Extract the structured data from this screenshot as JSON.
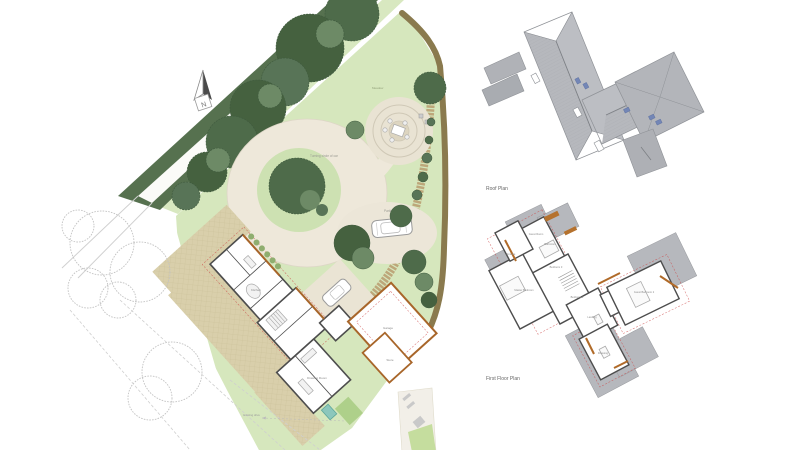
{
  "site_plan": {
    "north_label": "N",
    "road_label": "Bridleway Drive",
    "labels": {
      "turning_circle": "Turning circle of car",
      "parking": "Parking",
      "meadow": "Meadow",
      "garage": "Garage",
      "kitchen": "Kitchen",
      "drawing_room": "Drawing Room",
      "store": "Store",
      "existing_drive": "Existing drive"
    }
  },
  "roof_plan": {
    "caption": "Roof Plan"
  },
  "first_floor_plan": {
    "caption": "First Floor Plan",
    "rooms": [
      {
        "label": "Guest Room"
      },
      {
        "label": "Ensuite"
      },
      {
        "label": "Bathroom"
      },
      {
        "label": "Bedroom 3"
      },
      {
        "label": "Master Bedroom"
      },
      {
        "label": "Bedroom 2"
      },
      {
        "label": "Landing"
      },
      {
        "label": "Guest Bedroom 2"
      },
      {
        "label": "Dressing"
      }
    ]
  },
  "colors": {
    "tree_dark": "#4e6b4a",
    "tree_mid": "#6d8a66",
    "lawn": "#d6e7bd",
    "paving": "#eae4d4",
    "hedge_brown": "#8a7a4e",
    "roof_gray": "#b6b8bd",
    "wall_dark": "#4d4d4d",
    "timber_orange": "#b06a28",
    "skylight_blue": "#7386b6",
    "red_dashed": "#cc4444",
    "pool_teal": "#8cc7bc"
  }
}
